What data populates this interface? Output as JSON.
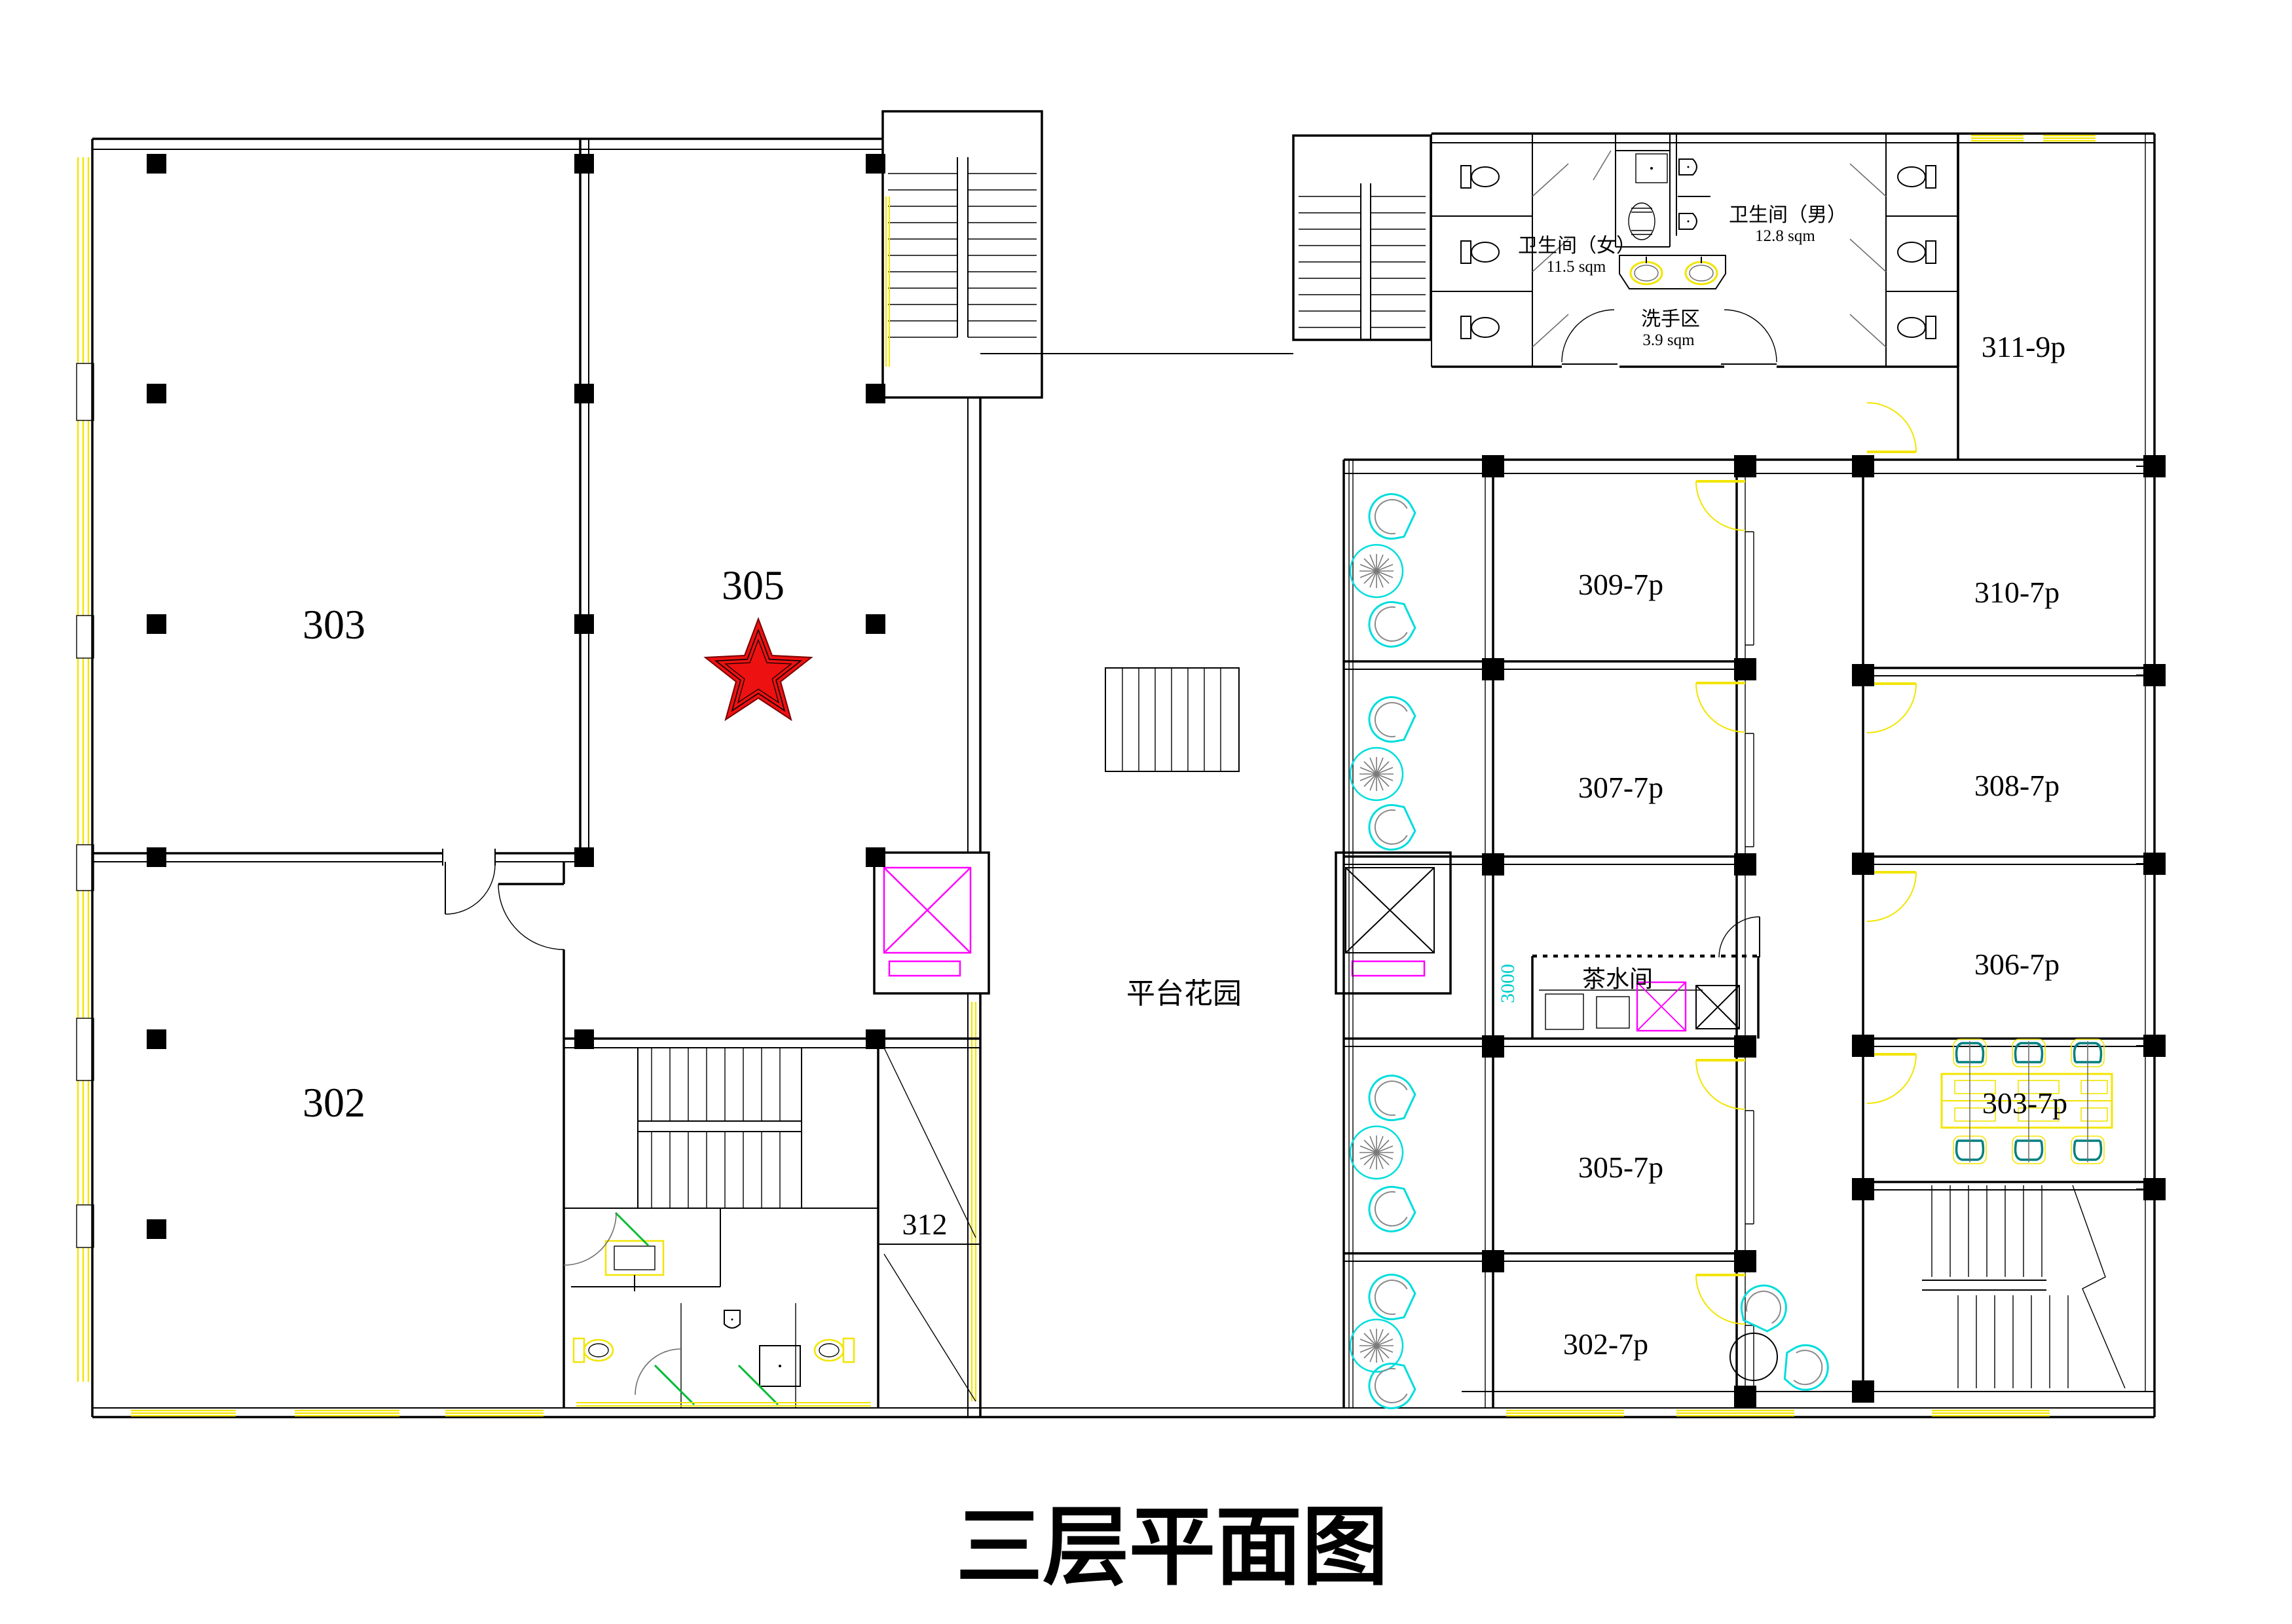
{
  "title": "三层平面图",
  "rooms_left": {
    "r303": "303",
    "r305": "305",
    "r302": "302",
    "r312": "312"
  },
  "rooms_right": {
    "r311": "311-9p",
    "r310": "310-7p",
    "r309": "309-7p",
    "r308": "308-7p",
    "r307": "307-7p",
    "r306": "306-7p",
    "r305": "305-7p",
    "r303": "303-7p",
    "r302": "302-7p"
  },
  "areas": {
    "garden": "平台花园",
    "tea_room": "茶水间",
    "wc_women": "卫生间（女）",
    "wc_women_size": "11.5 sqm",
    "wc_men": "卫生间（男）",
    "wc_men_size": "12.8 sqm",
    "wash": "洗手区",
    "wash_size": "3.9 sqm"
  },
  "dimensions": {
    "corridor_width": "3000"
  },
  "marker": {
    "starred_room": "305",
    "icon": "red-star"
  },
  "colors": {
    "wall": "#000000",
    "accent_red": "#ee1111",
    "cad_yellow": "#f2e500",
    "cad_cyan": "#00dddd",
    "cad_magenta": "#ff00ff",
    "cad_green": "#00bb33",
    "chair_teal": "#007f7f"
  }
}
